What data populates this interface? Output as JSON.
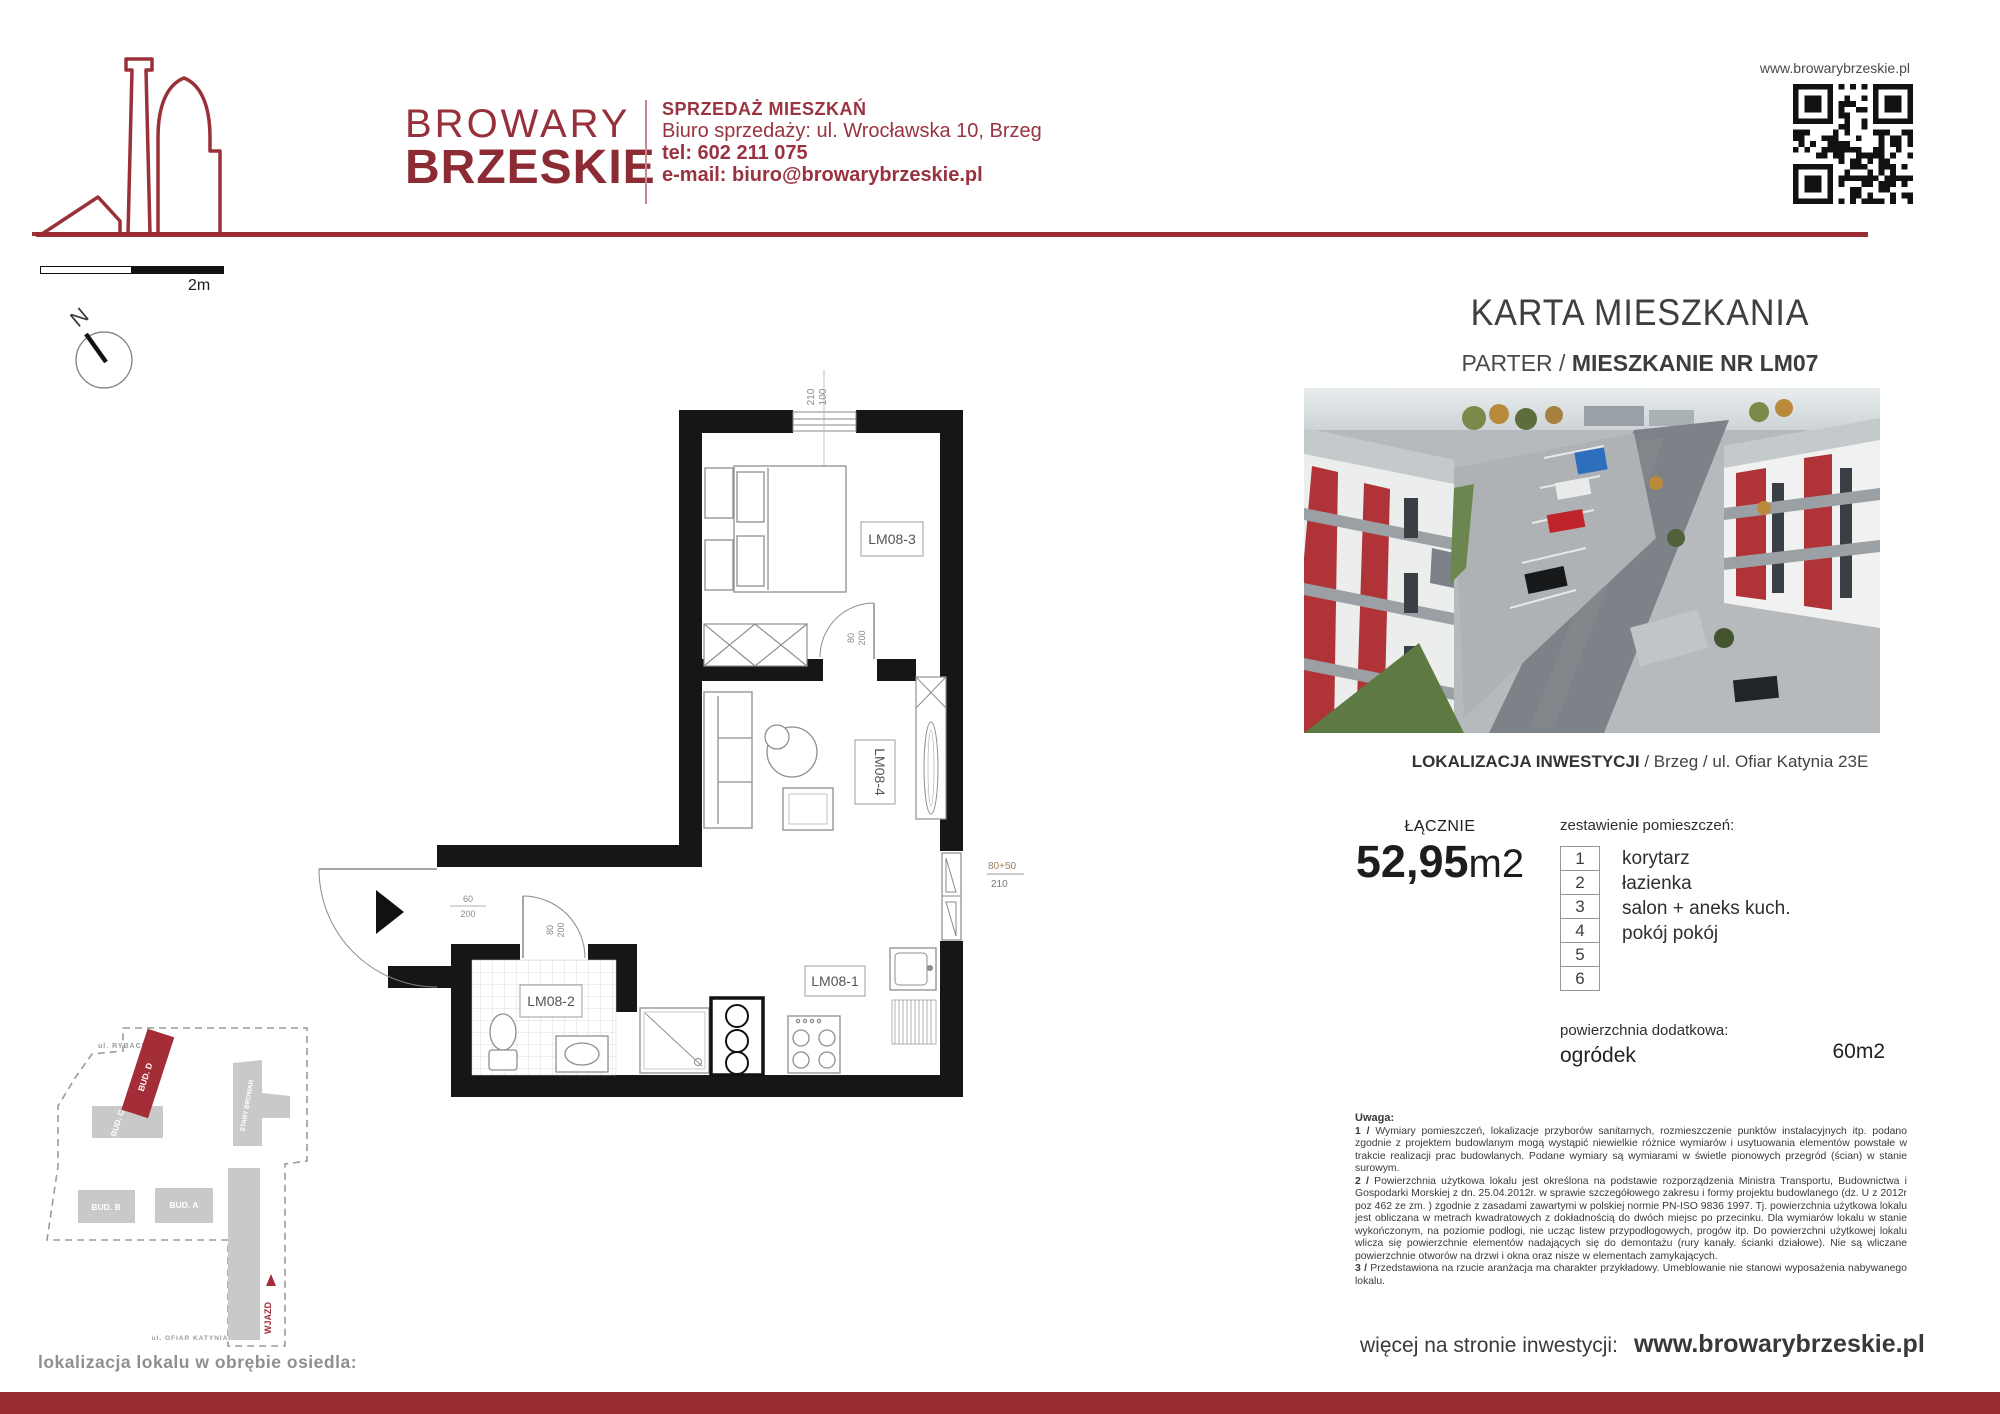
{
  "header": {
    "brand_line1": "BROWARY",
    "brand_line2": "BRZESKIE",
    "tagline": "SPRZEDAŻ MIESZKAŃ",
    "address": "Biuro sprzedaży: ul. Wrocławska 10, Brzeg",
    "phone": "tel: 602 211 075",
    "email": "e-mail: biuro@browarybrzeskie.pl",
    "website_top": "www.browarybrzeskie.pl"
  },
  "scalebar": {
    "label": "2m"
  },
  "compass": {
    "label": "N"
  },
  "card": {
    "title": "KARTA MIESZKANIA",
    "floor": "PARTER",
    "separator": " / ",
    "unit_title": "MIESZKANIE NR LM07",
    "location_bold": "LOKALIZACJA INWESTYCJI",
    "location_rest": " / Brzeg / ul. Ofiar Katynia 23E"
  },
  "summary": {
    "total_label": "ŁĄCZNIE",
    "area_value": "52,95",
    "area_unit": "m2",
    "rooms_heading": "zestawienie pomieszczeń:",
    "rooms": [
      {
        "no": "1",
        "name": "korytarz"
      },
      {
        "no": "2",
        "name": "łazienka"
      },
      {
        "no": "3",
        "name": "salon + aneks kuch."
      },
      {
        "no": "4",
        "name": "pokój pokój"
      },
      {
        "no": "5",
        "name": ""
      },
      {
        "no": "6",
        "name": ""
      }
    ],
    "additional_heading": "powierzchnia dodatkowa:",
    "additional_name": "ogródek",
    "additional_value": "60m2"
  },
  "notes": {
    "heading": "Uwaga:",
    "items": [
      {
        "num": "1 /",
        "text": " Wymiary pomieszczeń, lokalizacje przyborów sanitarnych, rozmieszczenie punktów instalacyjnych itp. podano zgodnie z projektem budowlanym mogą wystąpić niewielkie różnice wymiarów i usytuowania elementów powstałe w trakcie realizacji prac budowlanych. Podane wymiary są wymiarami w świetle pionowych przegród (ścian) w stanie surowym."
      },
      {
        "num": "2 /",
        "text": " Powierzchnia użytkowa lokalu jest określona na podstawie rozporządzenia Ministra Transportu, Budownictwa i Gospodarki Morskiej z dn. 25.04.2012r. w sprawie szczegółowego zakresu i formy projektu budowlanego (dz. U z 2012r poz 462 ze zm. ) zgodnie z zasadami zawartymi w polskiej normie PN-ISO 9836 1997. Tj. powierzchnia użytkowa lokalu jest obliczana w metrach kwadratowych z dokładnością do dwóch miejsc po przecinku. Dla wymiarów lokalu w stanie wykończonym, na poziomie podłogi, nie ucząc listew przypodłogowych, progów itp. Do powierzchni użytkowej lokalu wlicza się powierzchnie elementów nadających się do demontażu (rury kanały. ścianki działowe). Nie są wliczane powierzchnie otworów na drzwi i okna oraz nisze w elementach zamykających."
      },
      {
        "num": "3 /",
        "text": " Przedstawiona na rzucie aranżacja ma charakter przykładowy. Umeblowanie nie stanowi wyposażenia nabywanego lokalu."
      }
    ]
  },
  "footer": {
    "more_label": "więcej na stronie inwestycji:",
    "website": "www.browarybrzeskie.pl"
  },
  "floorplan": {
    "room_labels": {
      "bedroom": "LM08-3",
      "living": "LM08-4",
      "bathroom": "LM08-2",
      "kitchen": "LM08-1"
    },
    "dims": {
      "window_w": "210",
      "window_h": "100",
      "bedroom_door_w": "80",
      "bedroom_door_h": "200",
      "entry_w": "60",
      "entry_h": "200",
      "bath_door_w": "80",
      "bath_door_h": "200",
      "balcony_w": "80+50",
      "balcony_h": "210"
    }
  },
  "siteplan": {
    "caption": "lokalizacja lokalu w obrębie osiedla:",
    "street_top": "ul. RYBACKA",
    "street_bottom": "ul. OFIAR KATYNIA",
    "entry_label": "WJAZD",
    "buildings": {
      "d": "BUD. D",
      "c": "BUD. C",
      "b": "BUD. B",
      "a": "BUD. A",
      "brewery": "STARY BROWAR"
    }
  },
  "colors": {
    "brand_red": "#96303a",
    "bar_red": "#9a2d32",
    "map_red": "#a32e38",
    "wall_black": "#161616"
  }
}
